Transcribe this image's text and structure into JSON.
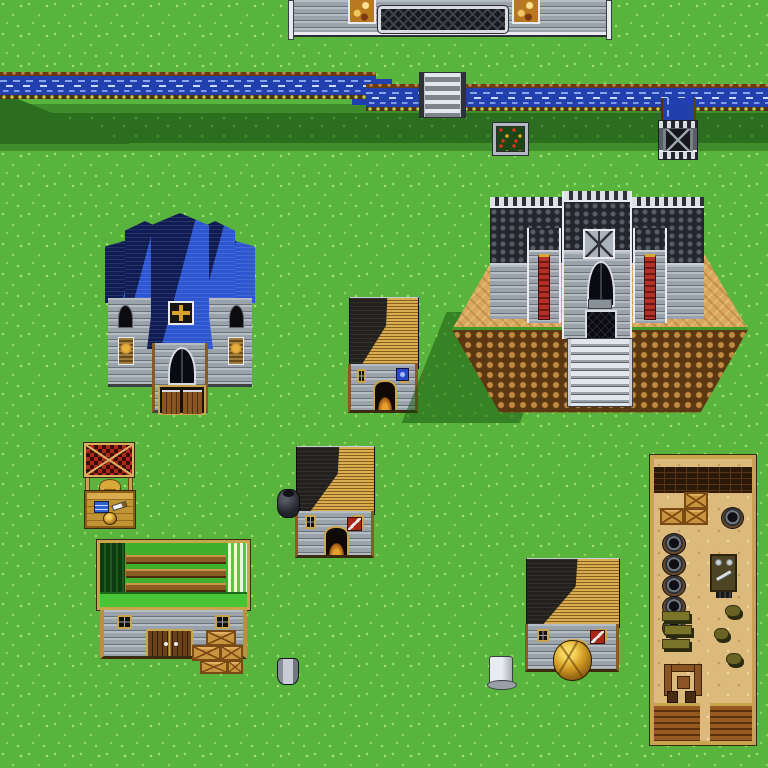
{
  "meta": {
    "title": "SNES-style JRPG town map (overhead view)",
    "viewport": {
      "width": 768,
      "height": 768
    },
    "visible_text": "none"
  },
  "palette": {
    "grass": "#58b43c",
    "grass_speckle": "#9ade68",
    "grass_shadow": "#2c6e20",
    "water_deep": "#2140ae",
    "water_wave": "#8aa4ec",
    "bank_brown": "#6a3a12",
    "stone_light": "#9aa2ac",
    "stone_cobble_dark": "#3a3e46",
    "white_trim": "#e8ecf0",
    "roof_blue": "#2e56d0",
    "roof_blue_shade": "#101c54",
    "roof_gold": "#c59a3e",
    "roof_shade": "#23211d",
    "roof_green": "#49c436",
    "wood_tan": "#c8a44c",
    "wood_dark": "#6a4018",
    "banner_red": "#b23028",
    "canopy_red": "#b02818",
    "dirt_plateau": "#d8a860",
    "cliff_brown": "#7a4c1c",
    "floor_tan": "#dcba7c",
    "door_glow": "#c87820",
    "gold": "#d8a838"
  },
  "entities": {
    "shade_band_top": {
      "x": 0,
      "y": 104,
      "w": 768,
      "h": 9
    },
    "shade_band": {
      "x": 0,
      "y": 113,
      "w": 768,
      "h": 30
    },
    "shade_band_bot": {
      "x": 0,
      "y": 143,
      "w": 768,
      "h": 8
    },
    "shade_wedge": {
      "x": 0,
      "y": 92,
      "w": 130,
      "h": 52
    },
    "river_west": {
      "x": 0,
      "y": 75,
      "w": 376,
      "h": 21
    },
    "river_bend": {
      "x": 352,
      "y": 79,
      "w": 40,
      "h": 26
    },
    "river_east": {
      "x": 366,
      "y": 87,
      "w": 402,
      "h": 21
    },
    "river_downflow": {
      "x": 661,
      "y": 98,
      "w": 31,
      "h": 28
    },
    "city_wall": {
      "x": 290,
      "y": 0,
      "w": 320,
      "h": 35
    },
    "bridge": {
      "x": 419,
      "y": 72,
      "w": 47,
      "h": 46
    },
    "garden_plot": {
      "x": 492,
      "y": 122,
      "w": 37,
      "h": 34
    },
    "drain_grate": {
      "x": 658,
      "y": 120,
      "w": 38,
      "h": 38
    },
    "church": {
      "x": 105,
      "y": 213,
      "w": 150,
      "h": 200
    },
    "house_1": {
      "x": 348,
      "y": 297,
      "w": 70,
      "h": 116
    },
    "castle_mound": {
      "x": 452,
      "y": 226,
      "w": 296,
      "h": 192
    },
    "castle": {
      "x": 490,
      "y": 191,
      "w": 214,
      "h": 215
    },
    "market_stall": {
      "x": 84,
      "y": 443,
      "w": 50,
      "h": 82
    },
    "house_2": {
      "x": 295,
      "y": 446,
      "w": 79,
      "h": 112
    },
    "big_pot": {
      "x": 277,
      "y": 489,
      "w": 21,
      "h": 27
    },
    "warehouse": {
      "x": 97,
      "y": 540,
      "w": 153,
      "h": 119
    },
    "crates_outside": {
      "x": 192,
      "y": 630,
      "w": 51,
      "h": 44
    },
    "house_3": {
      "x": 525,
      "y": 558,
      "w": 94,
      "h": 114
    },
    "gold_boulder": {
      "x": 553,
      "y": 640,
      "w": 37,
      "h": 39
    },
    "tavern": {
      "x": 650,
      "y": 455,
      "w": 106,
      "h": 290
    },
    "well_bucket": {
      "x": 277,
      "y": 658,
      "w": 20,
      "h": 25
    },
    "stone_marker": {
      "x": 489,
      "y": 656,
      "w": 22,
      "h": 27
    }
  },
  "entity_labels": {
    "city_wall": "castle-town outer wall with stained-glass windows and lattice grate",
    "river": "river flowing west-east with stone footbridge and drain outlet",
    "church": "cathedral with blue shingled gable roofs, rose window, gothic window, double doors",
    "castle": "stone keep with crenellated towers, two red banners, lattice gate and grand staircase on a dirt plateau",
    "house_1": "small stone cottage, open glowing doorway, blue shield ornament",
    "house_2": "weapon shop cottage with red knife sign and cauldron outside",
    "house_3": "weapon shop cottage with red knife sign, golden boulder blocking door",
    "market_stall": "merchant stall with red checkered canopy, merchant in hat, cloth, dagger and pot wares",
    "warehouse": "long green-roofed storehouse with double doors and stacked crates",
    "tavern": "roofless interior view: brick wall, crate pile, six barrels, counter with scales and sword, benches, stools, entrance walls",
    "props": "large black pot, stone well bucket, white stone marker, flower garden plot, water drain grate"
  },
  "counts": {
    "tavern_barrels_left": 5,
    "tavern_crates": 3,
    "tavern_benches": 3,
    "tavern_stools": 3,
    "outside_crates": 5,
    "castle_banners": 2,
    "stained_glass_windows": 2
  }
}
